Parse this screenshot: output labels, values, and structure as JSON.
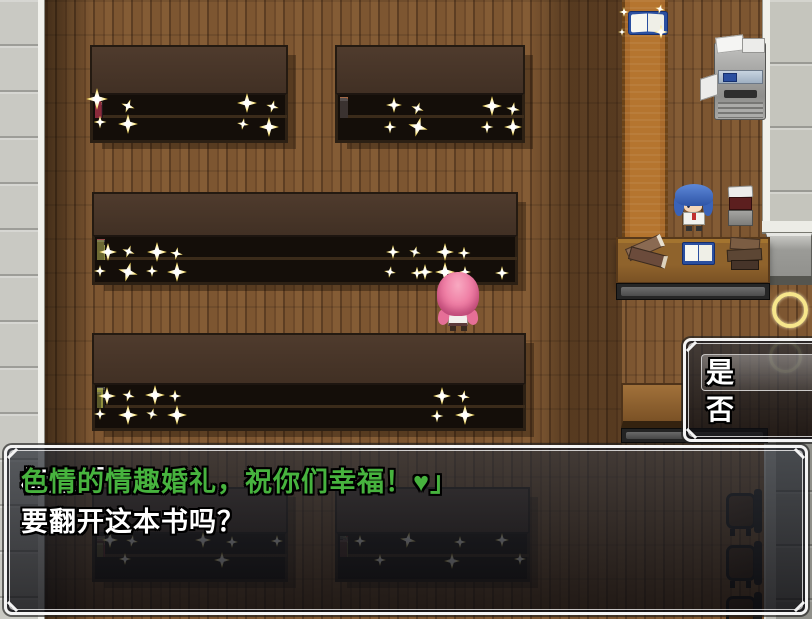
{
  "game": {
    "message_window": {
      "line1": [
        {
          "text": "标题「",
          "color": "#ffffff"
        },
        {
          "text": "色情的情趣婚礼，祝你们幸福！♥」",
          "color": "#47b33e"
        }
      ],
      "line2": "要翻开这本书吗？"
    },
    "choice_window": {
      "options": [
        "是",
        "否"
      ],
      "selected_index": 0
    },
    "colors": {
      "highlight_green": "#47b33e",
      "window_border": "#f4f4f4",
      "sparkle_gold": "#f3cf3a",
      "selection_ring_gold": "#f7e78c"
    }
  }
}
